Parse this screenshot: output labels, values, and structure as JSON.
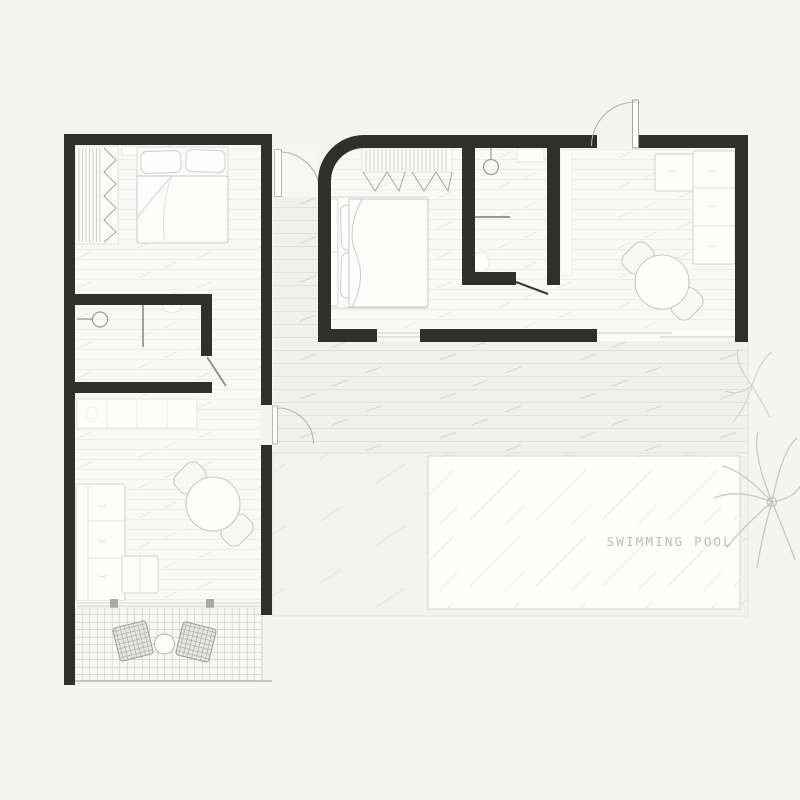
{
  "plan": {
    "pool_label": "SWIMMING POOL",
    "colors": {
      "background": "#f4f4f2",
      "wall": "#2f2f2d",
      "room_floor": "#f8f8f6",
      "deck_floor": "#f0f0ee",
      "terrace_floor": "#f2f2f0",
      "pool_fill": "#fdfdfc",
      "pool_border": "#dcdcda",
      "label_text": "#bcbcba",
      "furniture_fill": "#fdfdfc",
      "furniture_stroke": "#cfcfcd",
      "tile_line": "#cacac8",
      "door_arc": "#b3b3b1"
    }
  }
}
